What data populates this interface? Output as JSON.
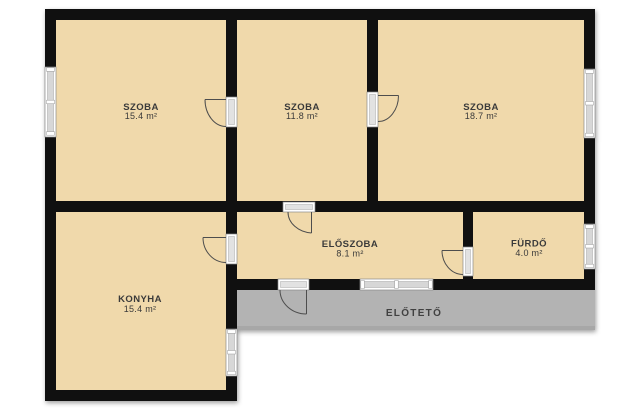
{
  "floorplan": {
    "rooms": [
      {
        "id": "szoba-1",
        "name": "SZOBA",
        "area": "15.4 m²"
      },
      {
        "id": "szoba-2",
        "name": "SZOBA",
        "area": "11.8 m²"
      },
      {
        "id": "szoba-3",
        "name": "SZOBA",
        "area": "18.7 m²"
      },
      {
        "id": "konyha",
        "name": "KONYHA",
        "area": "15.4 m²"
      },
      {
        "id": "eloszoba",
        "name": "ELŐSZOBA",
        "area": "8.1 m²"
      },
      {
        "id": "furdo",
        "name": "FÜRDŐ",
        "area": "4.0 m²"
      }
    ],
    "outdoor": {
      "name": "ELŐTETŐ"
    },
    "colors": {
      "floor": "#f0d9ab",
      "wall": "#101010",
      "porch": "#b3b3b3",
      "label": "#3a3a3a"
    }
  }
}
